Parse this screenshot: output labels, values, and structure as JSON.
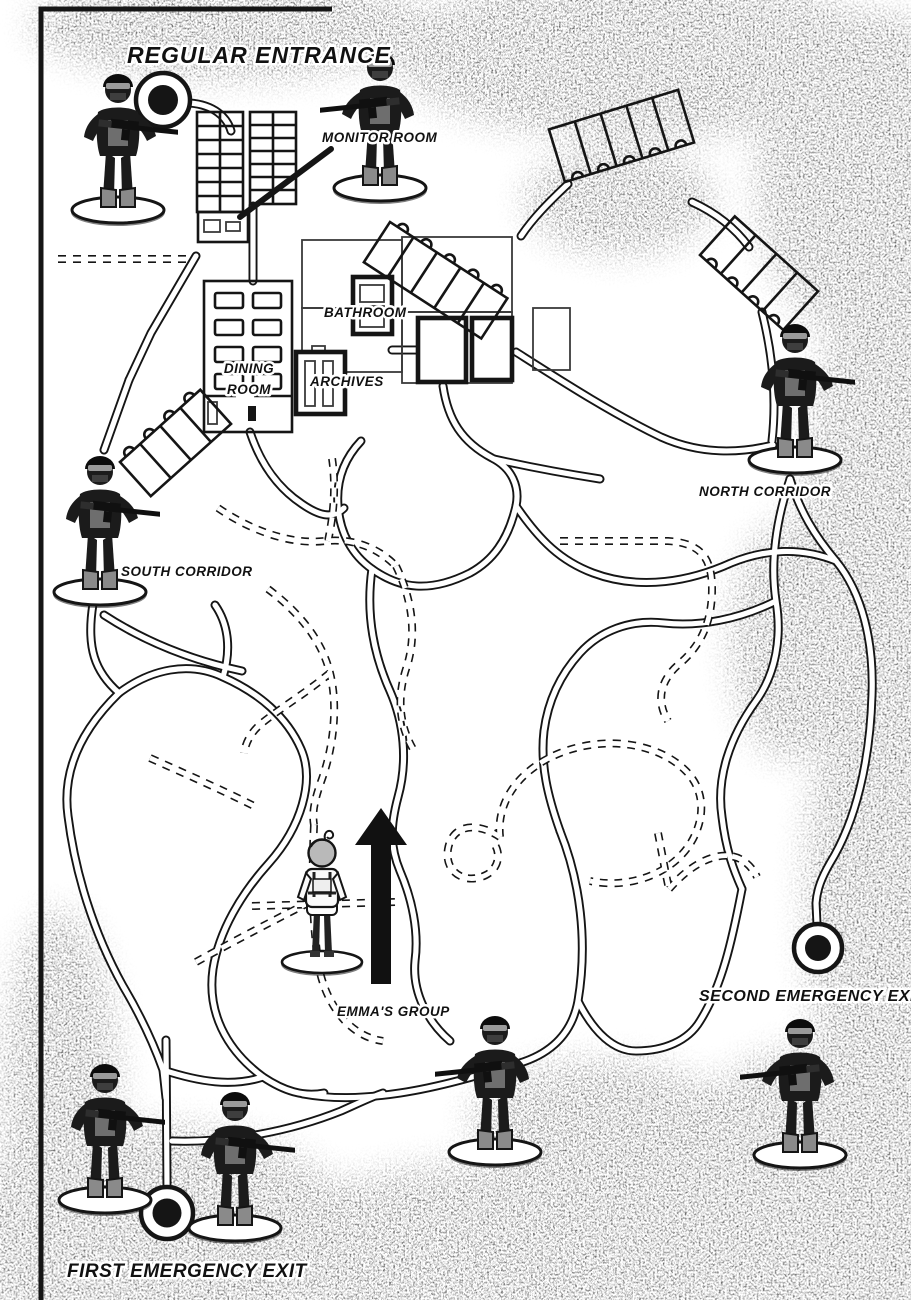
{
  "colors": {
    "ink": "#151515",
    "paper": "#ffffff"
  },
  "labels": {
    "regular_entrance": "REGULAR ENTRANCE",
    "monitor_room": "MONITOR ROOM",
    "bathroom": "BATHROOM",
    "dining_room_line1": "DINING",
    "dining_room_line2": "ROOM",
    "archives": "ARCHIVES",
    "north_corridor": "NORTH CORRIDOR",
    "south_corridor": "SOUTH CORRIDOR",
    "emmas_group": "EMMA'S GROUP",
    "second_emergency_exit": "SECOND EMERGENCY EXIT",
    "first_emergency_exit": "FIRST EMERGENCY EXIT"
  },
  "map": {
    "markers": [
      {
        "id": "regular-entrance-marker"
      },
      {
        "id": "first-emergency-exit-marker"
      },
      {
        "id": "second-emergency-exit-marker"
      }
    ],
    "figures": {
      "soldier_count": 8,
      "soldiers": [
        {
          "id": "soldier-regular-entrance",
          "post": "Regular Entrance"
        },
        {
          "id": "soldier-monitor-room",
          "post": "Monitor Room"
        },
        {
          "id": "soldier-north-corridor",
          "post": "North Corridor"
        },
        {
          "id": "soldier-south-corridor",
          "post": "South Corridor"
        },
        {
          "id": "soldier-central-tunnels",
          "post": "Central tunnels"
        },
        {
          "id": "soldier-second-emergency-exit",
          "post": "Second Emergency Exit"
        },
        {
          "id": "soldier-first-emergency-exit-west",
          "post": "First Emergency Exit (left)"
        },
        {
          "id": "soldier-first-emergency-exit-east",
          "post": "First Emergency Exit (right)"
        }
      ],
      "emma": {
        "id": "emma-group-figure",
        "arrow_direction": "up"
      }
    }
  }
}
